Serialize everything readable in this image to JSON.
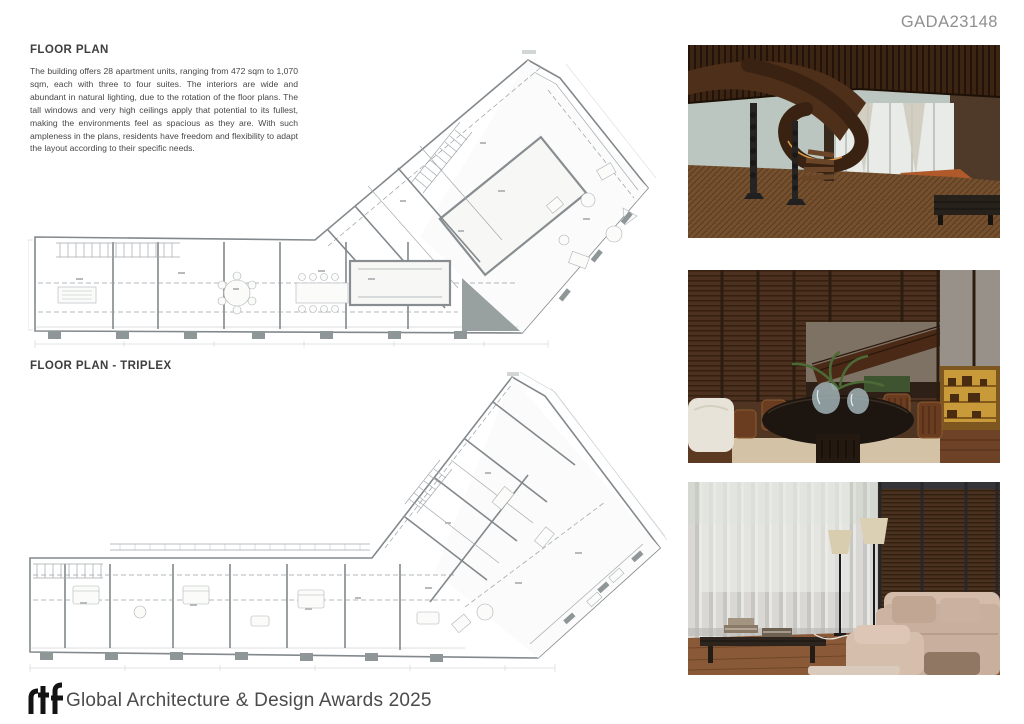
{
  "board": {
    "code": "GADA23148",
    "footer": {
      "logo_text": "rtf",
      "award_text": "Global Architecture & Design Awards 2025"
    }
  },
  "sections": {
    "floor_plan": {
      "heading": "FLOOR PLAN",
      "body": "The building offers 28 apartment units, ranging from 472 sqm to 1,070 sqm, each with three to four suites. The interiors are wide and abundant in natural lighting, due to the rotation of the floor plans. The tall windows and very high ceilings apply that potential to its fullest, making the environments feel as spacious as they are. With such ampleness in the plans, residents have freedom and flexibility to adapt the layout according to their specific needs."
    },
    "floor_plan_triplex": {
      "heading": "FLOOR PLAN - TRIPLEX"
    }
  },
  "photos": [
    {
      "id": "photo-staircase",
      "subject": "Sculptural curved wood staircase in a lobby with herringbone parquet floor and slatted wood ceiling"
    },
    {
      "id": "photo-dining",
      "subject": "Dining area with round black table, glass vases and wooden chairs against slatted wood partitions"
    },
    {
      "id": "photo-living",
      "subject": "Living room with full-height sheer curtains, floor lamps, low bench with books and beige sofas"
    }
  ],
  "colors": {
    "code_text": "#8f8f8f",
    "heading_text": "#3e3e3e",
    "body_text": "#474747",
    "footer_text": "#4b4b4b",
    "logo": "#131313",
    "plan_line": "#82888c"
  }
}
